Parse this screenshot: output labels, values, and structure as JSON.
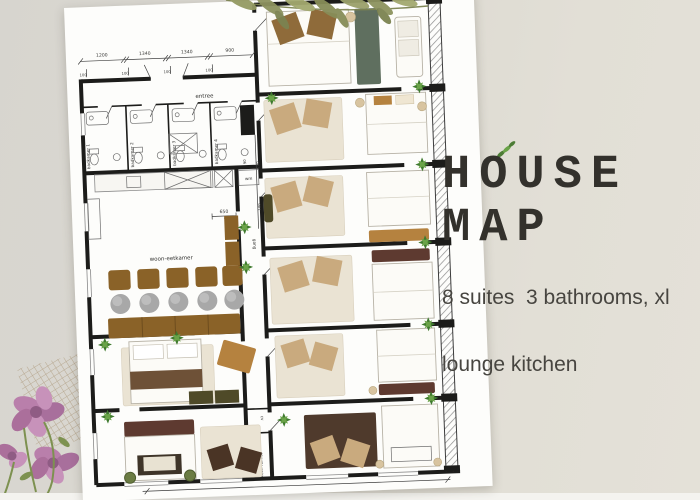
{
  "poster": {
    "title_line1": "HOUSE",
    "title_line2": "MAP",
    "subtitle_line1": "8 suites  3 bathrooms, xl",
    "subtitle_line2": "lounge kitchen"
  },
  "floorplan": {
    "rooms": {
      "entree": "entree",
      "badkamers": [
        "badkamer 1",
        "badkamer 2",
        "badkamer 3",
        "badkamer 4"
      ],
      "woon_eetkamer": "woon-eetkamer",
      "gang": "gang",
      "wm": "wm",
      "cv": "cv",
      "tech_ruimte": "tech ruimte"
    },
    "dimensions": {
      "top": [
        "1200",
        "1340",
        "1340",
        "900"
      ],
      "ticks": [
        "100",
        "100",
        "100",
        "100"
      ],
      "side_650": "650",
      "side_200": "200",
      "side_100": "100",
      "side_90": "90"
    }
  },
  "colors": {
    "background": "#dcd9d1",
    "paper": "#fdfdfb",
    "wall_ink": "#1c1c1a",
    "title_text": "#33312c",
    "subtitle_text": "#474540",
    "wood_brown": "#8a6228",
    "pillow_brown": "#8f6b3a",
    "pillow_tan": "#c9aa7e",
    "rug_cream": "#eae3d3",
    "bench_caramel": "#b5823f",
    "bench_maroon": "#5e3a30",
    "rug_dark_brown": "#4f3a2c",
    "rug_sage": "#5f6f5f",
    "cabinet_olive": "#4f4a28",
    "plant_green": "#3f7a2e",
    "seat_gray": "#a8a8a8",
    "flower_pink": "#bd85ae"
  }
}
